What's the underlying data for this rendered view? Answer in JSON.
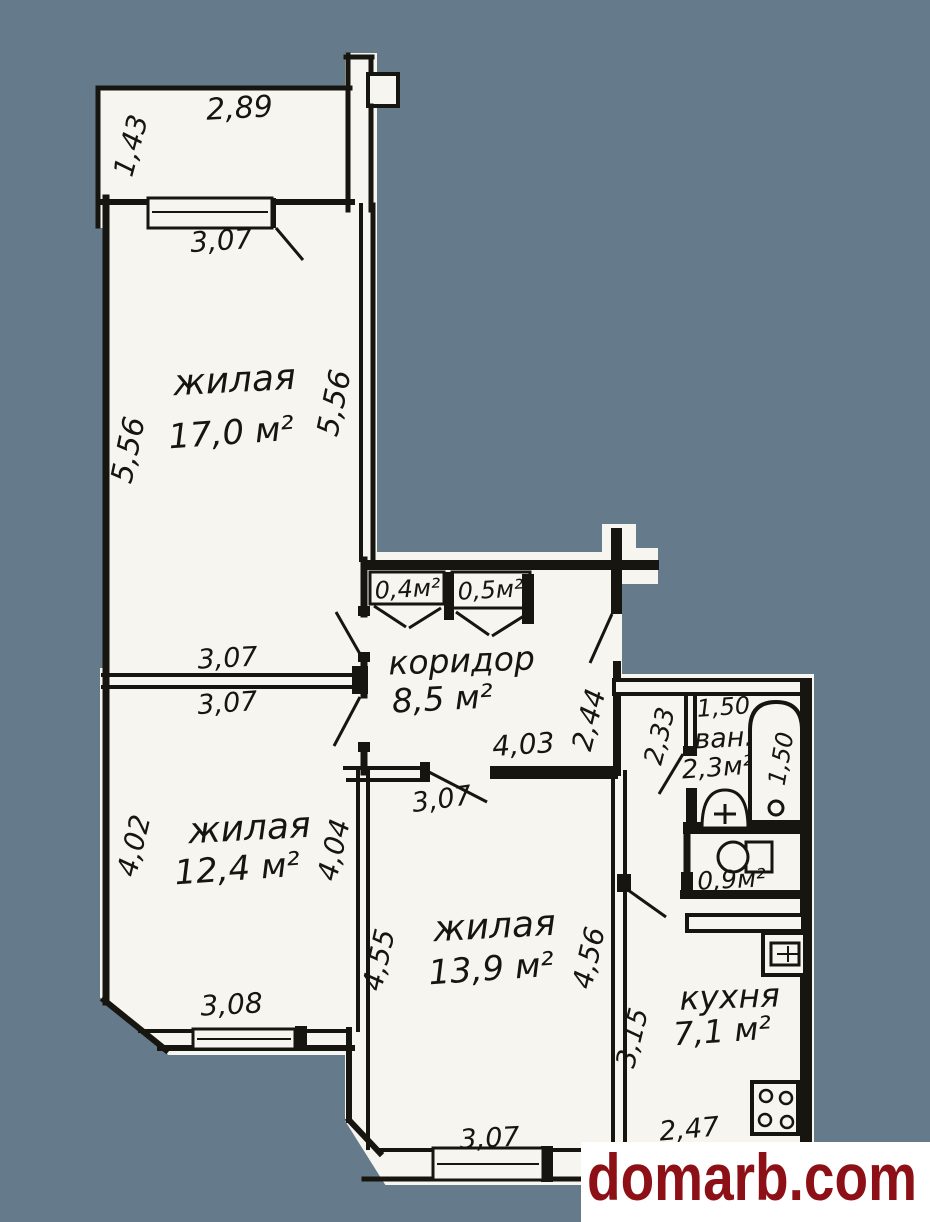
{
  "palette": {
    "background": "#657a8a",
    "paper": "#f7f5ef",
    "ink": "#17150f",
    "watermark_red": "#8c1016"
  },
  "watermark": {
    "text": "domarb.com"
  },
  "balcony": {
    "dim_top": "2,89",
    "dim_left": "1,43"
  },
  "room1": {
    "label": "жилая",
    "area": "17,0 м²",
    "dim_window": "3,07",
    "dim_left": "5,56",
    "dim_right": "5,56",
    "dim_bottom": "3,07"
  },
  "room2": {
    "label": "жилая",
    "area": "12,4 м²",
    "dim_top": "3,07",
    "dim_left": "4,02",
    "dim_right": "4,04",
    "dim_bottom": "3,08"
  },
  "room3": {
    "label": "жилая",
    "area": "13,9 м²",
    "dim_top": "4,03",
    "dim_door": "3,07",
    "dim_left": "4,55",
    "dim_right": "4,56",
    "dim_bottom": "3,07"
  },
  "corridor": {
    "label": "коридор",
    "area": "8,5 м²",
    "closet_left": "0,4м²",
    "closet_right": "0,5м²",
    "dim_entrance": "2,44"
  },
  "bathroom": {
    "label": "ван.",
    "area": "2,3м²",
    "dim_top": "1,50",
    "dim_left": "2,33",
    "dim_tub": "1,50"
  },
  "toilet": {
    "area": "0,9м²"
  },
  "kitchen": {
    "label": "кухня",
    "area": "7,1 м²",
    "dim_left": "3,15",
    "dim_bottom": "2,47"
  }
}
